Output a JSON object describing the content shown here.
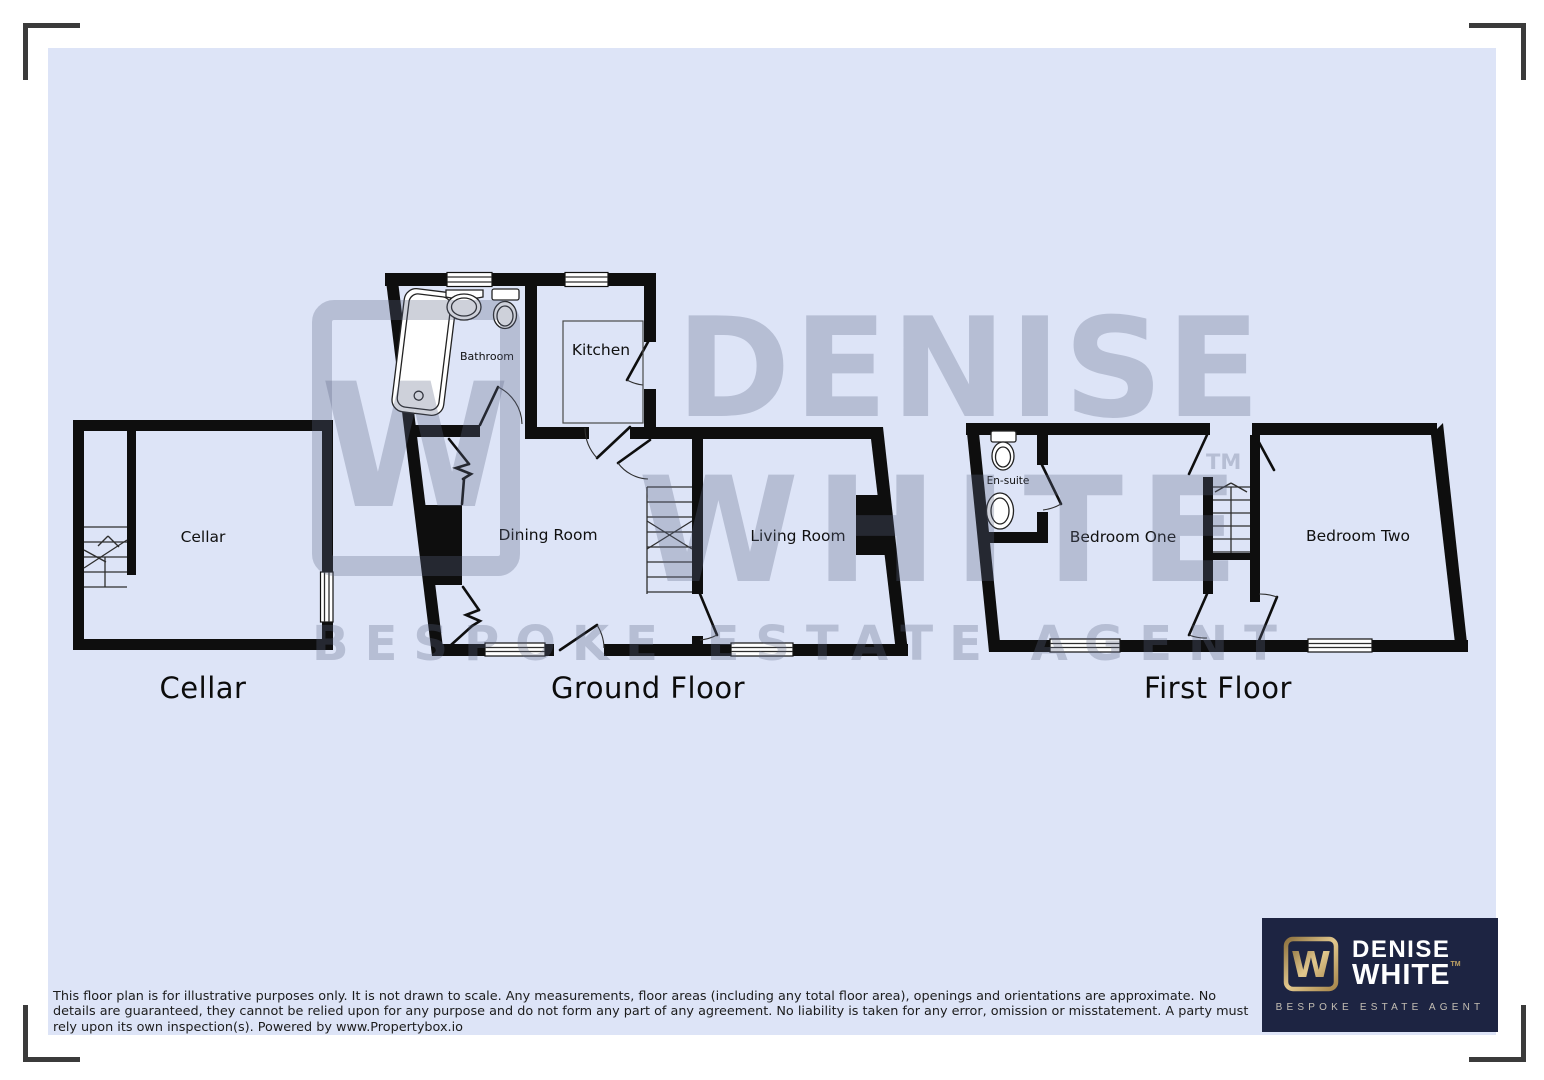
{
  "page": {
    "background": "#ffffff",
    "canvas_color": "#dde4f7",
    "wall_color": "#0e0e0e",
    "watermark_color": "rgba(92,103,132,0.30)"
  },
  "plans": {
    "cellar": {
      "title": "Cellar",
      "rooms": {
        "cellar": "Cellar"
      }
    },
    "ground_floor": {
      "title": "Ground Floor",
      "rooms": {
        "bathroom": "Bathroom",
        "kitchen": "Kitchen",
        "dining_room": "Dining Room",
        "living_room": "Living Room"
      }
    },
    "first_floor": {
      "title": "First Floor",
      "rooms": {
        "ensuite": "En-suite",
        "bedroom_one": "Bedroom One",
        "bedroom_two": "Bedroom Two"
      }
    }
  },
  "watermark": {
    "word1": "DENISE",
    "word2": "WHITE",
    "tm": "TM",
    "tagline": "BESPOKE ESTATE AGENT",
    "monogram": "W"
  },
  "logo": {
    "word1": "DENISE",
    "word2": "WHITE",
    "tm": "TM",
    "tagline": "BESPOKE ESTATE AGENT",
    "monogram": "W",
    "background": "#1d2442",
    "gold": "#c2a368"
  },
  "disclaimer": {
    "line1": "This floor plan is for illustrative purposes only. It is not drawn to scale. Any measurements, floor areas (including any total floor area), openings and orientations are approximate. No",
    "line2": "details are guaranteed, they cannot be relied upon for any purpose and do not form any part of any agreement. No liability is taken for any error, omission or misstatement. A party must",
    "line3": "rely upon its own inspection(s). Powered by www.Propertybox.io"
  }
}
